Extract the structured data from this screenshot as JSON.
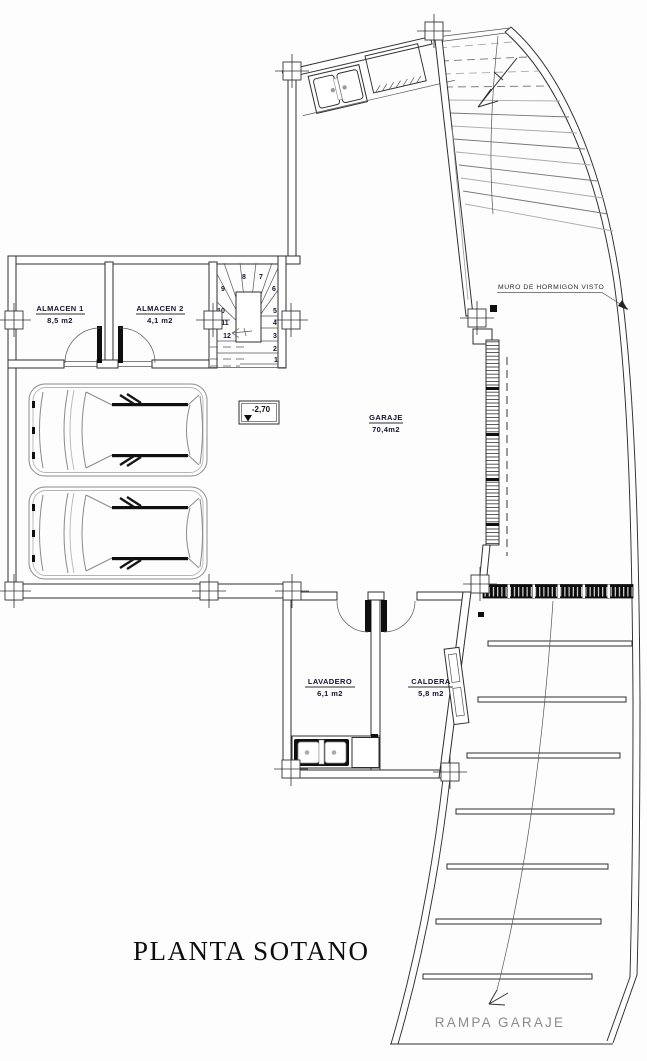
{
  "drawing": {
    "title": "PLANTA SOTANO",
    "rooms": {
      "almacen1": {
        "name": "ALMACEN 1",
        "area": "8,5 m2"
      },
      "almacen2": {
        "name": "ALMACEN 2",
        "area": "4,1 m2"
      },
      "garaje": {
        "name": "GARAJE",
        "area": "70,4m2"
      },
      "lavadero": {
        "name": "LAVADERO",
        "area": "6,1 m2"
      },
      "caldera": {
        "name": "CALDERA",
        "area": "5,8 m2"
      }
    },
    "annotations": {
      "wall_note": "MURO DE HORMIGON VISTO",
      "ramp_label": "RAMPA GARAJE",
      "level": "-2,70"
    },
    "stair_numbers": [
      "1",
      "2",
      "3",
      "4",
      "5",
      "6",
      "7",
      "8",
      "9",
      "10",
      "11",
      "12"
    ],
    "colors": {
      "line": "#2e2e2e",
      "light": "#9a9a9a",
      "text": "#14142e",
      "gray": "#8b8b8b"
    }
  }
}
